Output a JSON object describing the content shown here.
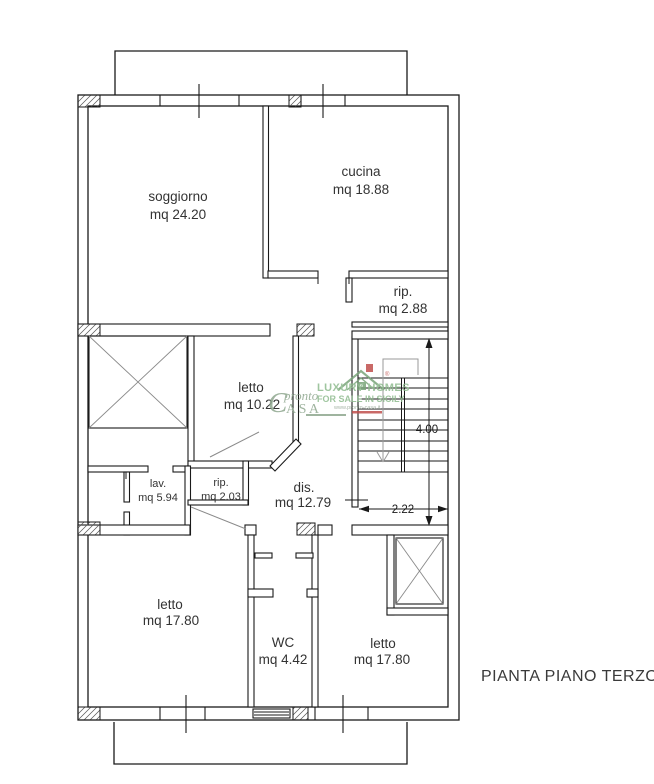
{
  "title": "PIANTA PIANO TERZO",
  "rooms": [
    {
      "name": "soggiorno",
      "area": "mq 24.20"
    },
    {
      "name": "cucina",
      "area": "mq 18.88"
    },
    {
      "name": "rip.",
      "area": "mq 2.88"
    },
    {
      "name": "letto",
      "area": "mq 10.22"
    },
    {
      "name": "lav.",
      "area": "mq 5.94"
    },
    {
      "name": "rip.",
      "area": "mq 2.03"
    },
    {
      "name": "dis.",
      "area": "mq 12.79"
    },
    {
      "name": "letto",
      "area": "mq 17.80"
    },
    {
      "name": "WC",
      "area": "mq 4.42"
    },
    {
      "name": "letto",
      "area": "mq 17.80"
    }
  ],
  "dimensions": {
    "stair_flight_length": "4.00",
    "stair_width": "2.22"
  },
  "watermark": {
    "brand_initial": "C",
    "brand_top": "pronto",
    "brand_bottom": "ASA",
    "registered": "®",
    "tagline1": "LUXURY HOMES",
    "tagline2": "FOR SALE IN SICILY",
    "url": "www.pronto-casa.it"
  },
  "colors": {
    "wall_line": "#1a1a1a",
    "gray_detail": "#8a8a8a",
    "watermark_green": "#8fa78f",
    "watermark_bright_green": "#8fbc8f",
    "watermark_red": "#c0504d",
    "text": "#333333"
  }
}
